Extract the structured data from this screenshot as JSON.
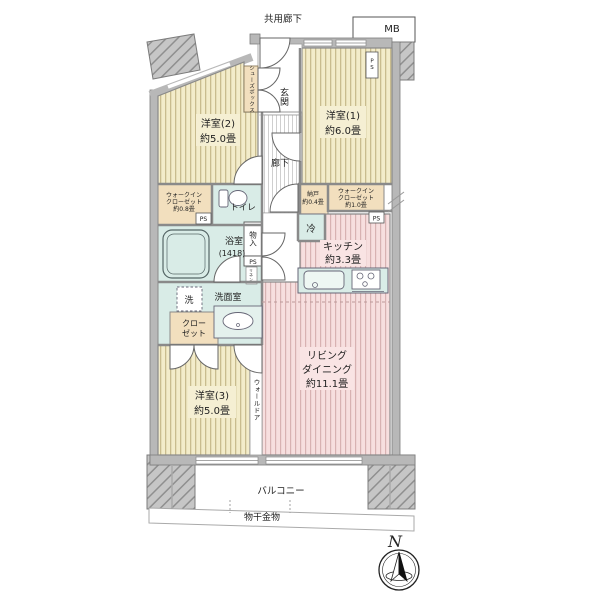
{
  "title": "間取り図",
  "labels": {
    "common_corridor": "共用廊下",
    "mb": "MB",
    "ps": "PS",
    "ps_vertical": "PS",
    "entrance": "玄関",
    "shoe_box": "シューズボックス",
    "hallway": "廊下",
    "western1_name": "洋室(1)",
    "western1_size": "約6.0畳",
    "western2_name": "洋室(2)",
    "western2_size": "約5.0畳",
    "western3_name": "洋室(3)",
    "western3_size": "約5.0畳",
    "living_line1": "リビング",
    "living_line2": "ダイニング",
    "living_size": "約11.1畳",
    "kitchen_name": "キッチン",
    "kitchen_size": "約3.3畳",
    "wic_line1": "ウォークイン",
    "wic_line2": "クローゼット",
    "wic_left_size": "約0.8畳",
    "wic_right_size": "約1.0畳",
    "nando_name": "納戸",
    "nando_size": "約0.4畳",
    "toilet": "トイレ",
    "bath_name": "浴室",
    "bath_size": "(1418)",
    "washroom": "洗面室",
    "washer": "洗",
    "closet_line1": "クロー",
    "closet_line2": "ゼット",
    "monoire": "物入",
    "fridge": "冷",
    "wall_door": "ウォールドア",
    "linen": "リネン",
    "balcony": "バルコニー",
    "drying_hardware": "物干金物",
    "north": "N"
  },
  "colors": {
    "wood_floor": "#f3ecca",
    "wood_stripe": "#c9bc8e",
    "living_floor": "#f7dfdf",
    "living_stripe": "#d8b2b2",
    "water_area": "#d9ece7",
    "storage_tan": "#f2dfbe",
    "wall_gray": "#b8b8b8",
    "hatch_gray": "#c6c6c6",
    "line_dark": "#666666"
  }
}
